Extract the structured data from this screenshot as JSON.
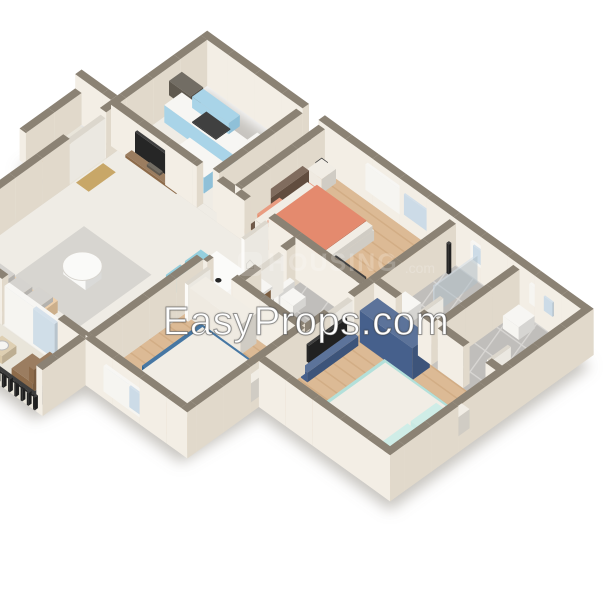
{
  "watermarks": {
    "primary": "EasyProps.com",
    "secondary": "HOUSING",
    "secondary_tld": ".com"
  },
  "palette": {
    "wallTop": "#8b8274",
    "wallLight": "#f3eee5",
    "wallDark": "#e1d9cb",
    "wood": "#dcba95",
    "woodStripe": "#c9a178",
    "tile": "#c0bebb",
    "tileLine": "#d9d7d4",
    "marble": "#efece5",
    "balconyFloor": "#e9e5da",
    "rug": "#d7d5d0",
    "doormat": "#c8a768",
    "cabinetBlue": "#a9d4e8",
    "cabinetBlueD": "#8fc0d8",
    "counter": "#f7f6f3",
    "darkCabinet": "#5f594f",
    "woodTop": "#8a5a33",
    "fixtureWhite": "#f6f5f1",
    "bedWhite": "#efeae1",
    "coral": "#e07a5a",
    "coralPillow": "#e68f70",
    "headboardBrown": "#6f5848",
    "dresserBrown": "#5c4a3d",
    "tealBed": "#a9dcd5",
    "tealPillow": "#c8eae4",
    "navy": "#46608c",
    "blueDuvet": "#2e6596",
    "sofaTan": "#eac9a0",
    "cushion": "#cfcdc8",
    "tableWhite": "#fafaf8",
    "chairTeal": "#85c9da",
    "pouf": "#d9c8a8",
    "woodShelf": "#8d6b4a",
    "tvDark": "#262626",
    "railing": "#242424",
    "glass": "#ccdbe7",
    "shadow": "#8f8a80"
  },
  "scene": {
    "type": "isometric-3d-floor-plan",
    "rooms": [
      {
        "name": "living-room",
        "floor": "marble",
        "items": [
          "wall-tv",
          "tv-shelf",
          "soundbar",
          "sofa",
          "chaise",
          "cushions",
          "area-rug",
          "coffee-table",
          "dining-table",
          "dining-chairs",
          "plates",
          "pouf",
          "doormat"
        ]
      },
      {
        "name": "kitchen",
        "floor": "marble",
        "items": [
          "counter",
          "hob",
          "island",
          "cutting-board",
          "fridge",
          "upper-cabinets"
        ]
      },
      {
        "name": "master-bedroom",
        "floor": "wood",
        "items": [
          "double-bed-coral",
          "headboard",
          "pillows",
          "nightstand",
          "lamp",
          "dresser",
          "tv",
          "window"
        ]
      },
      {
        "name": "middle-bedroom",
        "floor": "wood",
        "items": [
          "double-bed-teal",
          "wardrobe-navy",
          "tv-console",
          "tv",
          "nightstand"
        ]
      },
      {
        "name": "bottom-bedroom",
        "floor": "wood",
        "items": [
          "double-bed-blue",
          "wardrobe-white",
          "pillows",
          "window"
        ]
      },
      {
        "name": "bathroom-a",
        "floor": "tile",
        "items": [
          "shower",
          "sink",
          "glass-screen",
          "window",
          "door"
        ]
      },
      {
        "name": "bathroom-b",
        "floor": "tile",
        "items": [
          "shower",
          "sink",
          "toilet",
          "window",
          "door"
        ]
      },
      {
        "name": "common-bathroom",
        "floor": "tile",
        "items": [
          "toilet",
          "door"
        ]
      },
      {
        "name": "hallway",
        "floor": "marble",
        "items": [
          "vanity-sink"
        ]
      },
      {
        "name": "balcony",
        "floor": "concrete",
        "items": [
          "railing",
          "wood-armchair",
          "side-table"
        ]
      },
      {
        "name": "utility-balcony",
        "floor": "concrete",
        "items": [
          "railing"
        ]
      },
      {
        "name": "entry",
        "floor": "concrete",
        "items": [
          "entry-door",
          "doormat-outside"
        ]
      }
    ]
  }
}
